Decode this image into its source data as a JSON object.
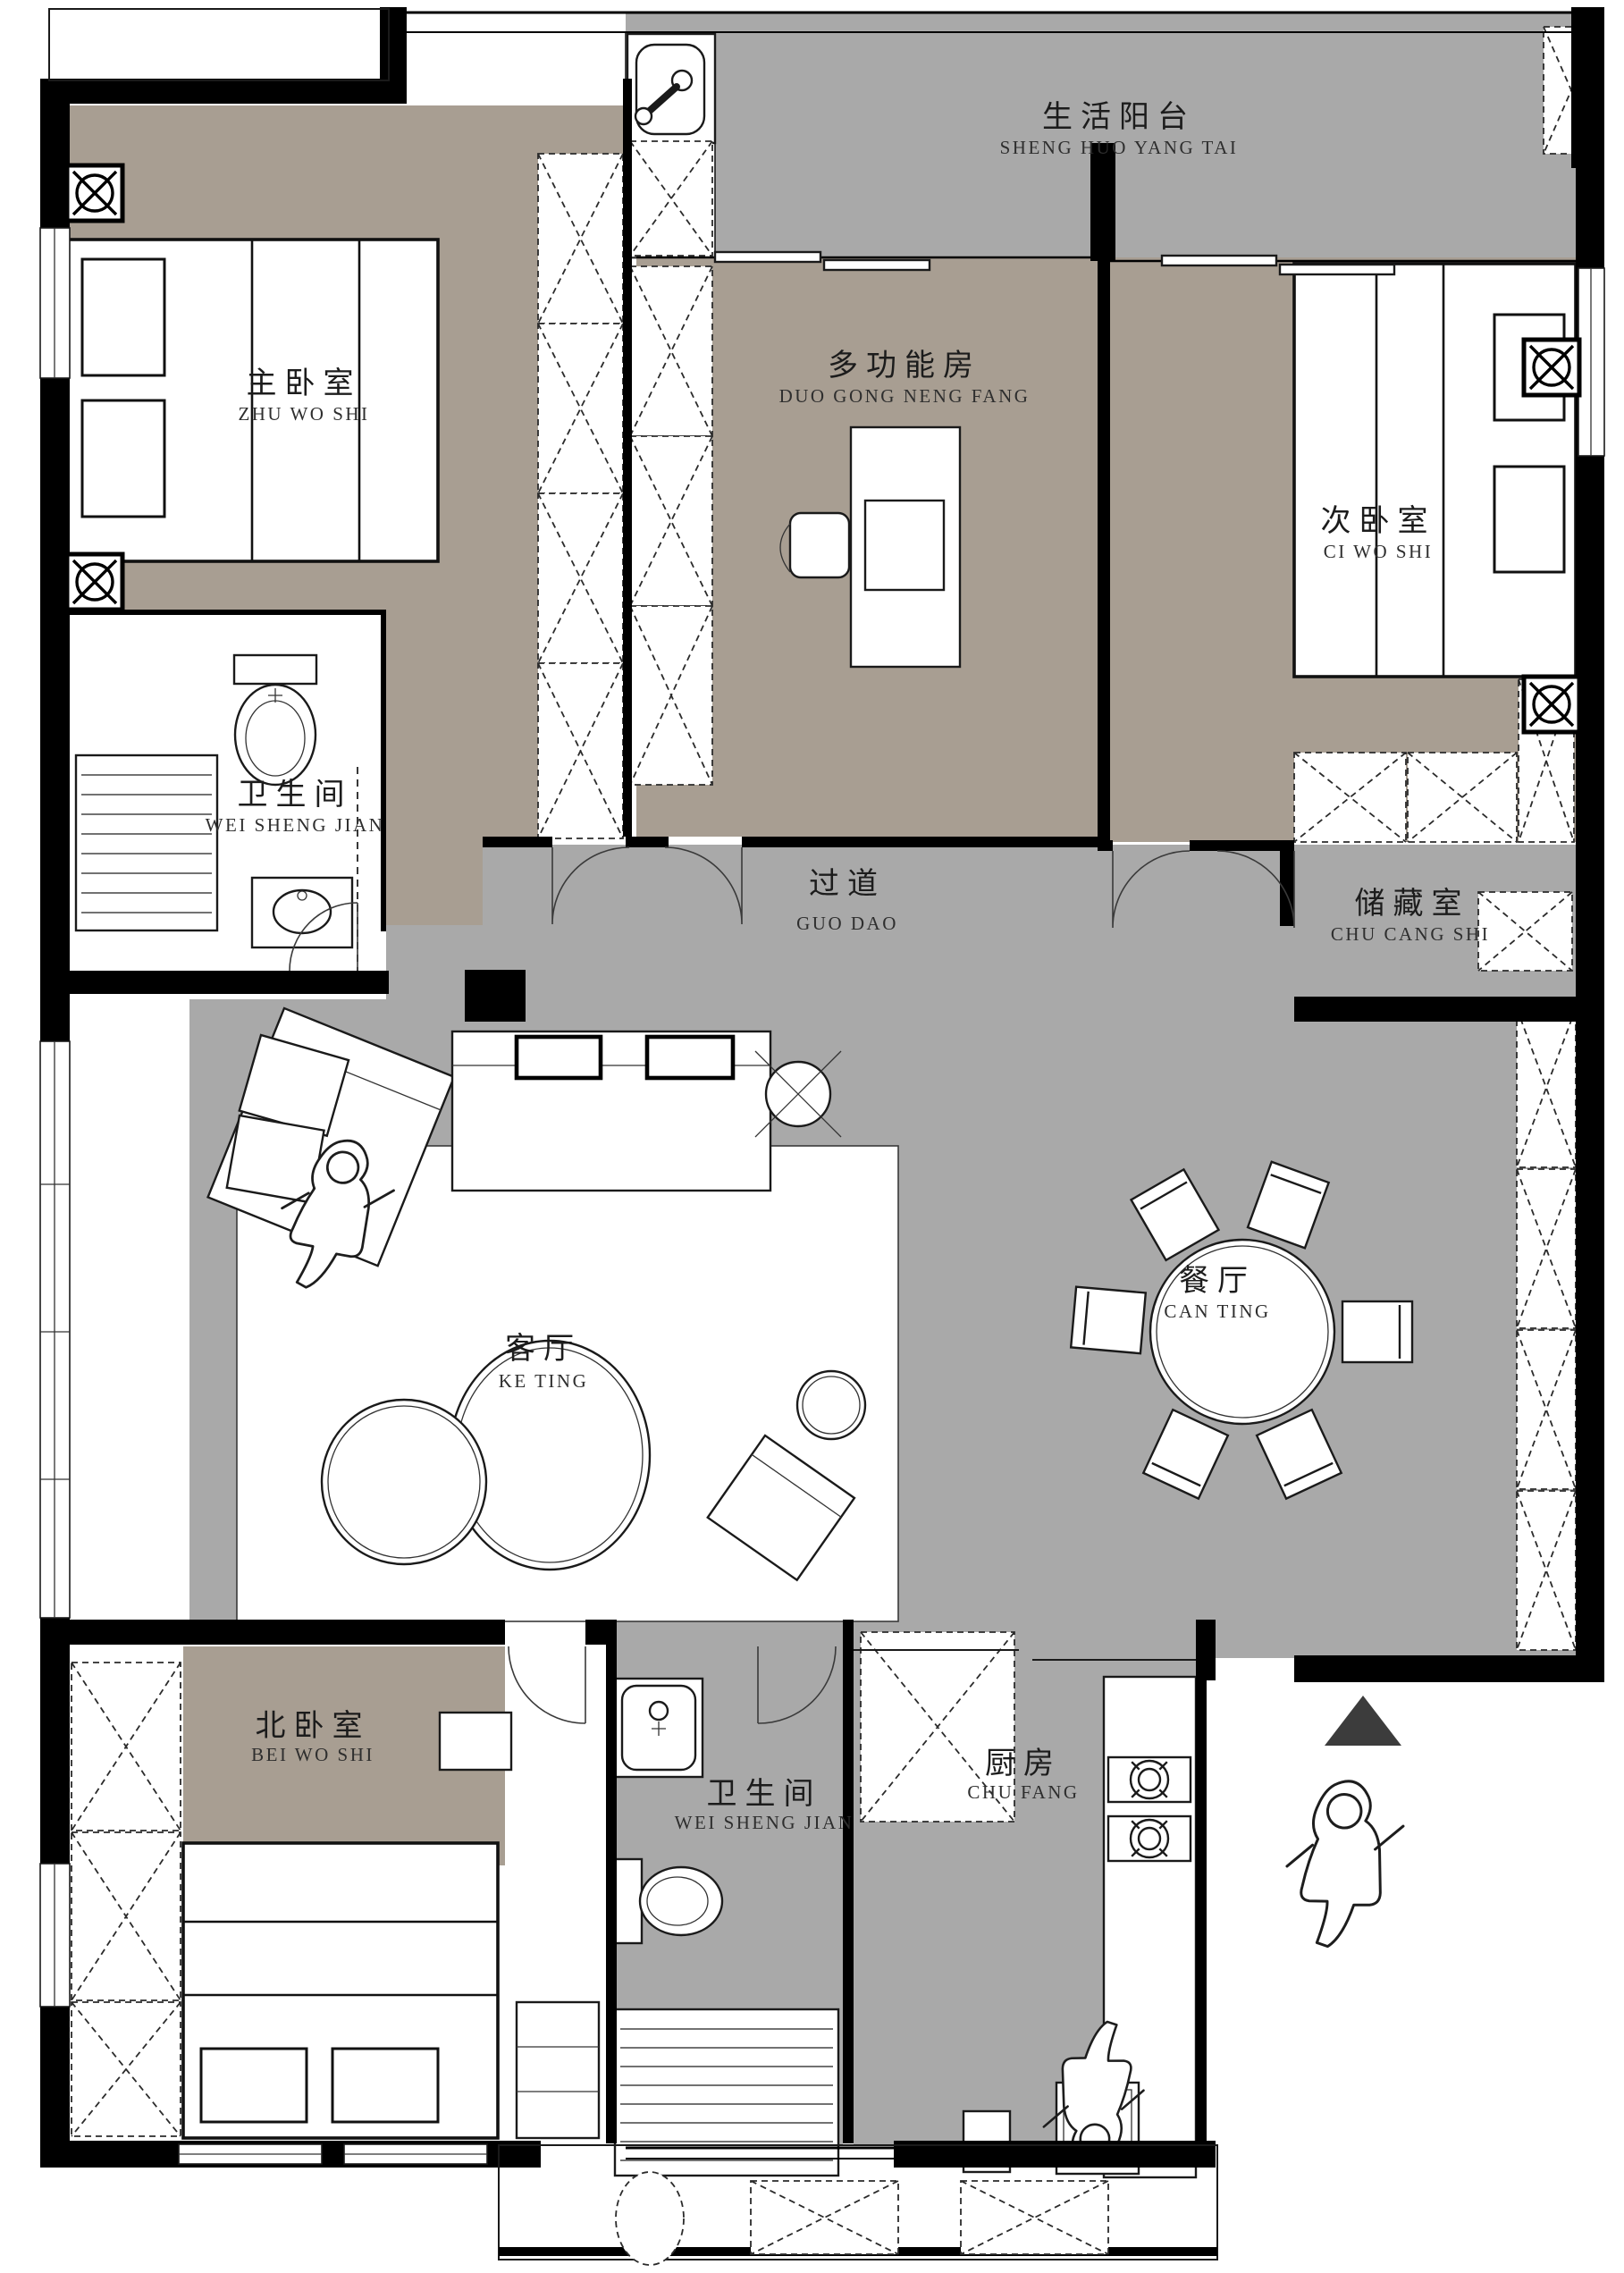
{
  "floorplan": {
    "type": "apartment-floor-plan",
    "colors": {
      "floor_warm": "#a89e92",
      "floor_gray": "#a9a9a9",
      "wall": "#000000",
      "furniture": "#ffffff",
      "north_arrow": "#3c3c3c"
    },
    "rooms": [
      {
        "id": "living-balcony",
        "zh": "生活阳台",
        "pinyin": "SHENG HUO YANG TAI"
      },
      {
        "id": "master-bedroom",
        "zh": "主卧室",
        "pinyin": "ZHU WO SHI"
      },
      {
        "id": "multi-function-room",
        "zh": "多功能房",
        "pinyin": "DUO GONG NENG FANG"
      },
      {
        "id": "secondary-bedroom",
        "zh": "次卧室",
        "pinyin": "CI WO SHI"
      },
      {
        "id": "bathroom-upper",
        "zh": "卫生间",
        "pinyin": "WEI SHENG JIAN"
      },
      {
        "id": "hallway",
        "zh": "过道",
        "pinyin": "GUO DAO"
      },
      {
        "id": "storage-room",
        "zh": "储藏室",
        "pinyin": "CHU CANG SHI"
      },
      {
        "id": "living-room",
        "zh": "客厅",
        "pinyin": "KE TING"
      },
      {
        "id": "dining-room",
        "zh": "餐厅",
        "pinyin": "CAN TING"
      },
      {
        "id": "north-bedroom",
        "zh": "北卧室",
        "pinyin": "BEI WO SHI"
      },
      {
        "id": "bathroom-lower",
        "zh": "卫生间",
        "pinyin": "WEI SHENG JIAN"
      },
      {
        "id": "kitchen",
        "zh": "厨房",
        "pinyin": "CHU FANG"
      }
    ],
    "symbols": {
      "north_arrow": "solid-triangle-up",
      "ceiling_lamp": "circle-cross-in-square",
      "fan_lamp": "circle-cross",
      "wardrobe_cell": "dashed-x-box",
      "person_figures": 3
    }
  }
}
